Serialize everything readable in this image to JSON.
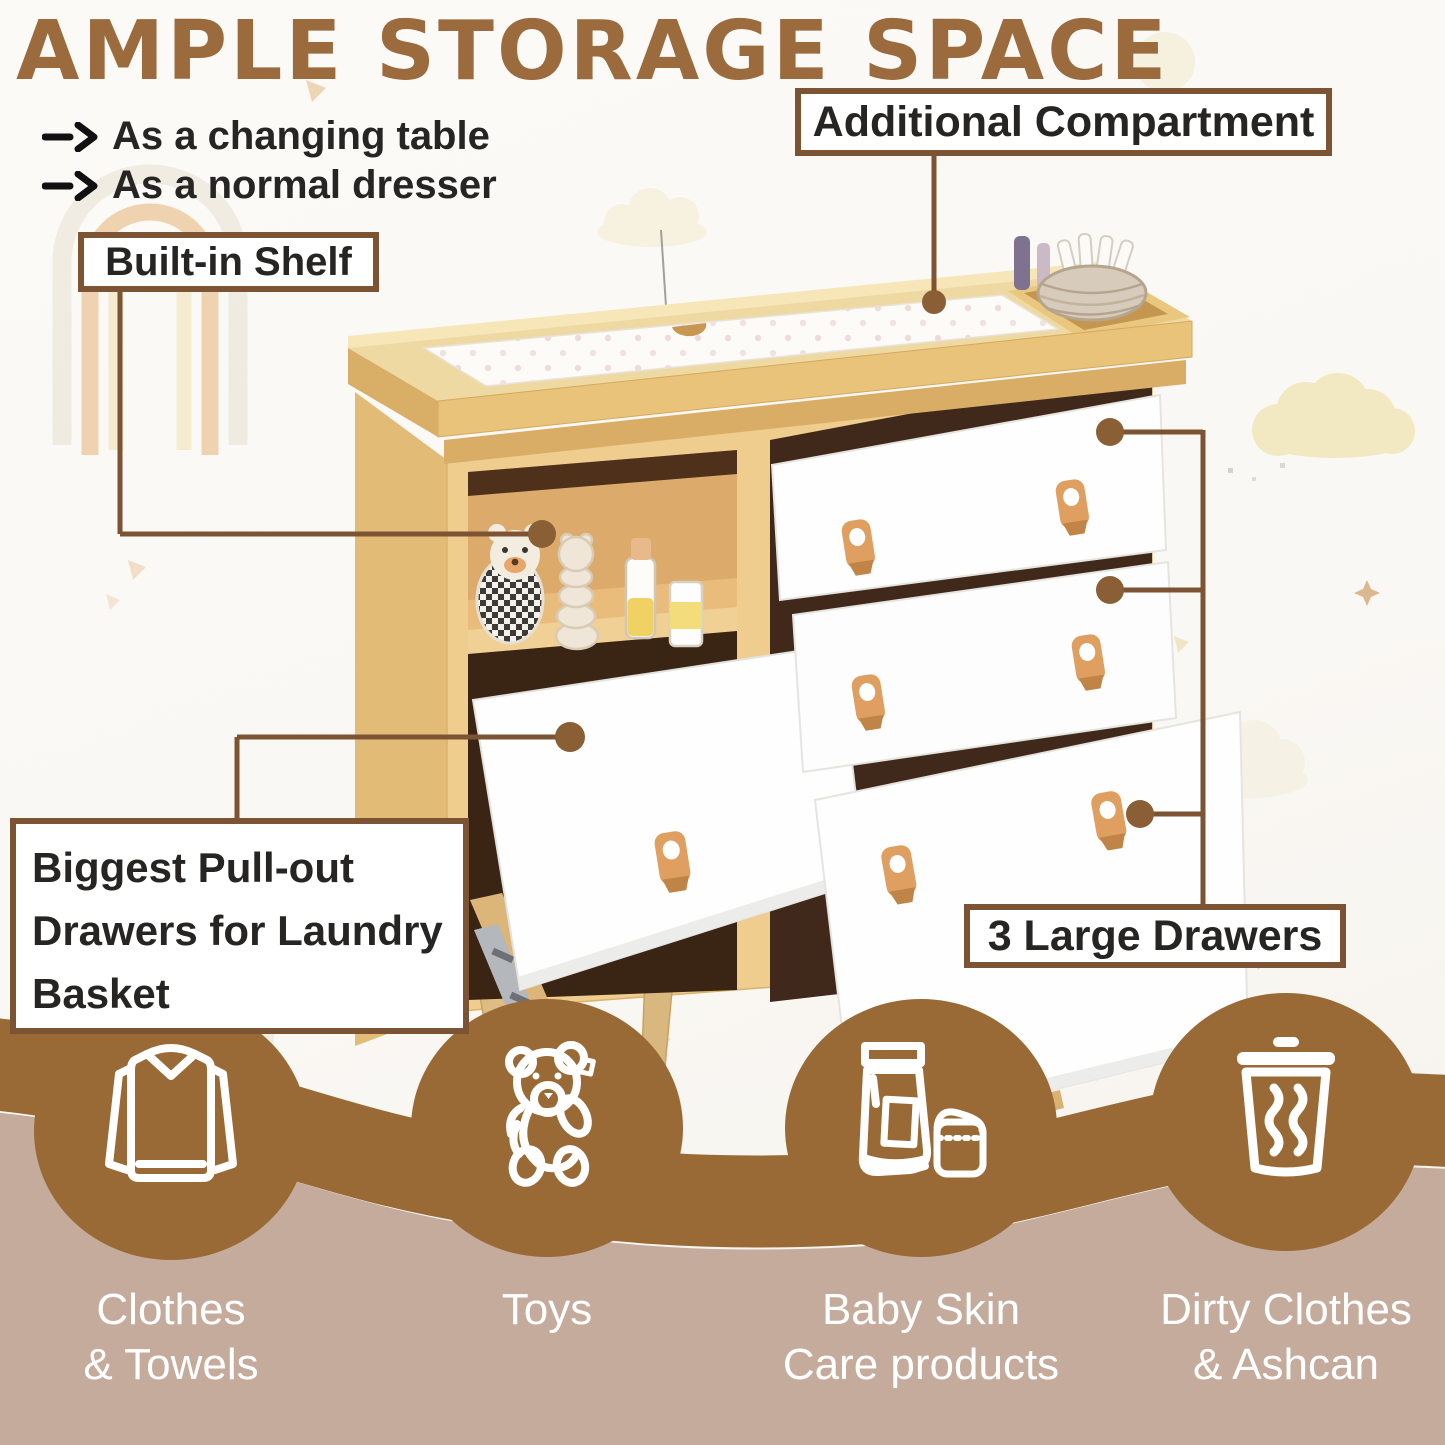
{
  "page": {
    "title": "AMPLE STORAGE SPACE"
  },
  "features": [
    {
      "label": "As a changing table"
    },
    {
      "label": "As a normal dresser"
    }
  ],
  "callouts": {
    "additional_compartment": "Additional Compartment",
    "built_in_shelf": "Built-in Shelf",
    "pull_out_drawer": "Biggest Pull-out Drawers for Laundry Basket",
    "large_drawers": "3 Large Drawers"
  },
  "storage_uses": [
    {
      "icon": "sweater-icon",
      "label": "Clothes\n& Towels"
    },
    {
      "icon": "teddy-bear-icon",
      "label": "Toys"
    },
    {
      "icon": "skincare-products-icon",
      "label": "Baby Skin\nCare products"
    },
    {
      "icon": "trash-can-icon",
      "label": "Dirty Clothes\n& Ashcan"
    }
  ],
  "colors": {
    "title_brown": "#9c6b3d",
    "callout_line_brown": "#7d5433",
    "circle_brown": "#996a36",
    "band_brown": "#996a36",
    "bottom_mauve": "#c5ab9c",
    "wood_light": "#eecd8e",
    "drawer_white": "#fefefe",
    "leather_tan": "#de9f60",
    "text_dark": "#262524",
    "caption_white": "#ffffff"
  }
}
